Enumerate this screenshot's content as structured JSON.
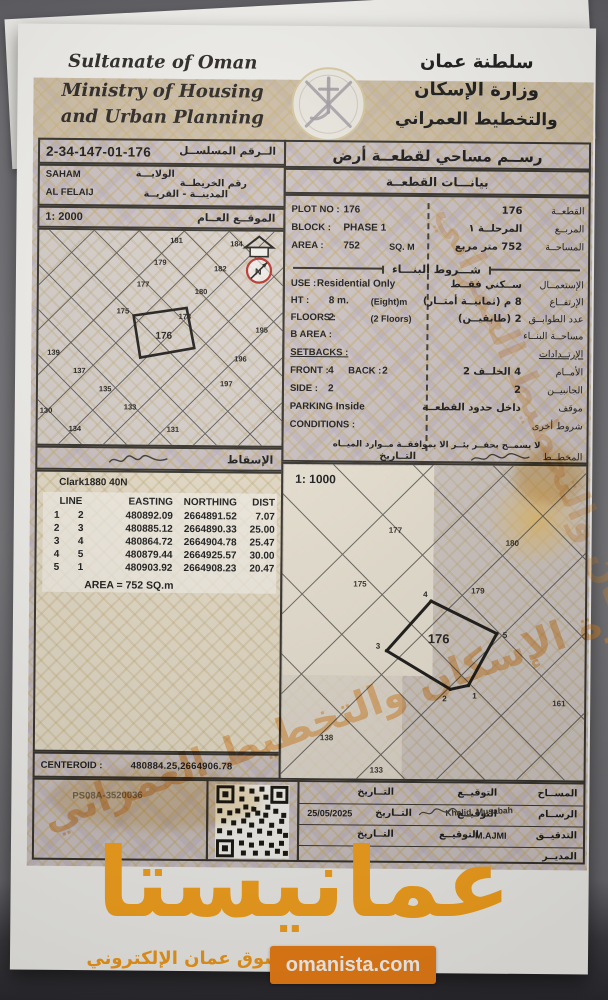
{
  "brand": {
    "orange": "#f59c1a",
    "logo": "عمانيستا",
    "tagline": "سوق عمان الإلكتروني",
    "site": "omanista.com",
    "diagonal_watermark": "وزارة الإسكان والتخطيط العمراني"
  },
  "header": {
    "country_en": "Sultanate of Oman",
    "ministry_en1": "Ministry of Housing",
    "ministry_en2": "and Urban Planning",
    "country_ar": "سلطنة عمان",
    "ministry_ar1": "وزارة الإسكان",
    "ministry_ar2": "والتخطيط العمراني"
  },
  "ref": {
    "serial": "2-34-147-01-176",
    "serial_label": "الــرقم المسلســل",
    "wilaya": "SAHAM",
    "wilaya_label": "الولايـــة",
    "map_no_label": "رقم الخريطــة",
    "town": "AL FELAIJ",
    "town_label": "المدينــة - القريــة",
    "scale": "1: 2000",
    "scale_label": "الموقــع العــام",
    "projection_label": "الإسقاط"
  },
  "title_block": {
    "title": "رســم مساحي لقطعــة أرض",
    "subtitle": "بيانـــات القطعــة",
    "building_header": "شـــروط البنـــاء"
  },
  "plot": {
    "rows": [
      {
        "l": "PLOT NO :",
        "v": "176",
        "av": "176",
        "al": "القطعــة"
      },
      {
        "l": "BLOCK :",
        "v": "PHASE 1",
        "av": "المرحلــة ١",
        "al": "المربــع"
      },
      {
        "l": "AREA :",
        "v": "752",
        "n": "SQ. M",
        "av": "752 متر مربع",
        "al": "المساحــة"
      }
    ]
  },
  "conditions": {
    "rows": [
      {
        "l": "USE :",
        "v": "Residential Only",
        "av": "ســكني فقــط",
        "al": "الإستعمــال"
      },
      {
        "l": "HT :",
        "v": "8 m.",
        "n": "(Eight)m",
        "av": "8 م (ثمانيــة أمتــار)",
        "al": "الإرتفــاع"
      },
      {
        "l": "FLOORS :",
        "v": "2",
        "n": "(2 Floors)",
        "av": "2 (طابقيــن)",
        "al": "عدد الطوابــق"
      },
      {
        "l": "B AREA :",
        "v": "",
        "av": "",
        "al": "مساحــة البنــاء"
      },
      {
        "l": "SETBACKS :",
        "v": "",
        "av": "",
        "al": "الإرتــدادات"
      },
      {
        "l": "FRONT :",
        "v": "4",
        "l2": "BACK :",
        "v2": "2",
        "av": "4 الخلــف 2",
        "al": "الأمــام"
      },
      {
        "l": "SIDE :",
        "v": "2",
        "av": "2",
        "al": "الجانبيــن"
      },
      {
        "l": "PARKING :",
        "v": "Inside",
        "av": "داخل حدود القطعــة",
        "al": "موقف"
      },
      {
        "l": "CONDITIONS :",
        "v": "",
        "av": "",
        "al": "شروط أخرى"
      }
    ],
    "note": "لا يسمــح بحفــر بئــر الا بموافقــة مــوارد الميــاه",
    "planner_label": "المخطــط",
    "date_label": "التــاريخ"
  },
  "coords": {
    "datum": "Clark1880 40N",
    "headers": [
      "LINE",
      "EASTING",
      "NORTHING",
      "DIST"
    ],
    "rows": [
      [
        "1",
        "2",
        "480892.09",
        "2664891.52",
        "7.07"
      ],
      [
        "2",
        "3",
        "480885.12",
        "2664890.33",
        "25.00"
      ],
      [
        "3",
        "4",
        "480864.72",
        "2664904.78",
        "25.47"
      ],
      [
        "4",
        "5",
        "480879.44",
        "2664925.57",
        "30.00"
      ],
      [
        "5",
        "1",
        "480903.92",
        "2664908.23",
        "20.47"
      ]
    ],
    "area_line": "AREA = 752  SQ.m",
    "centroid_label": "CENTEROID :",
    "centroid_value": "480884.25,2664906.78"
  },
  "locmap": {
    "plots": [
      "181",
      "184",
      "179",
      "182",
      "177",
      "180",
      "175",
      "178",
      "176",
      "195",
      "196",
      "197",
      "139",
      "137",
      "135",
      "133",
      "130",
      "134",
      "131"
    ]
  },
  "mainmap": {
    "scale": "1: 1000",
    "plot": "176",
    "vertices": [
      "1",
      "2",
      "3",
      "4",
      "5"
    ],
    "neighbors": [
      "177",
      "175",
      "179",
      "180",
      "161",
      "138",
      "133"
    ]
  },
  "footer": {
    "code": "PS08A-3520036",
    "rows": [
      {
        "role": "المســاح",
        "sig": "التوقيــع",
        "date_l": "التــاريخ",
        "name": "",
        "date": ""
      },
      {
        "role": "الرســام",
        "sig": "التوقيــع",
        "date_l": "التــاريخ",
        "name": "Khalid_Musabah",
        "date": "25/05/2025"
      },
      {
        "role": "التدقيــق",
        "sig": "التوقيــع",
        "date_l": "التــاريخ",
        "name": "M.AJMI",
        "date": ""
      },
      {
        "role": "المديــر",
        "sig": "",
        "date_l": "",
        "name": "",
        "date": ""
      }
    ]
  }
}
